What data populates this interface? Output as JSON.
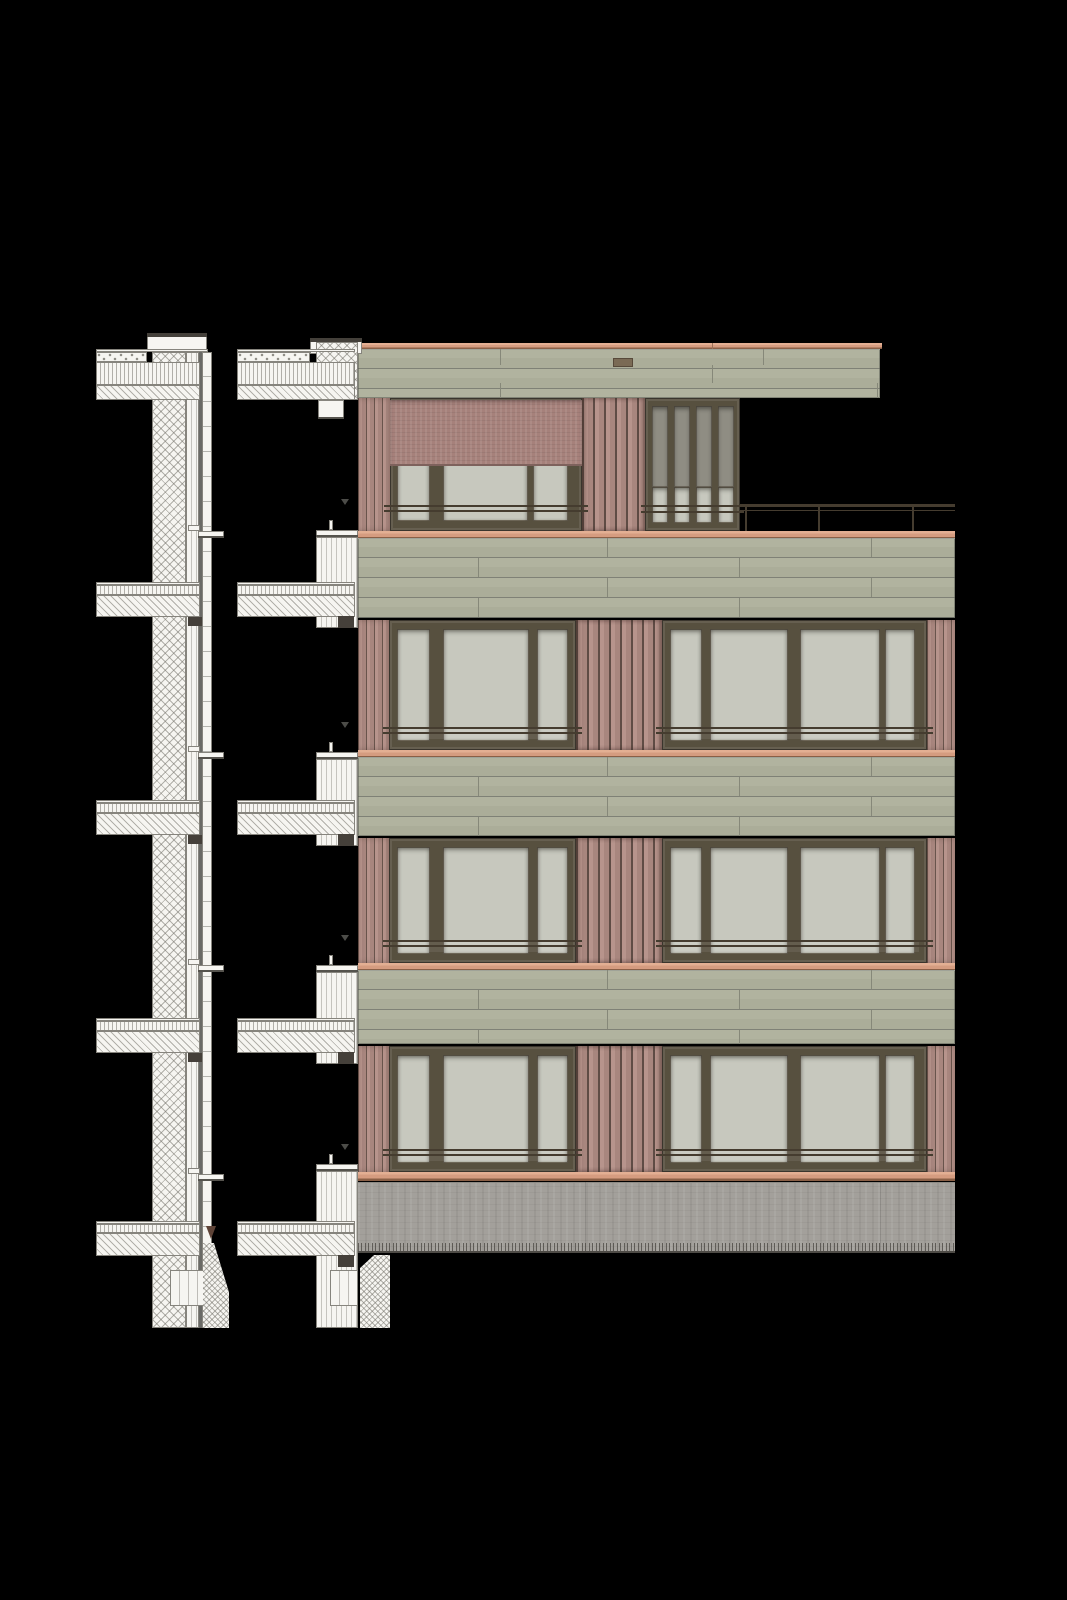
{
  "drawing": {
    "type": "architectural-facade-elevation-with-wall-sections",
    "canvas": {
      "width": 1067,
      "height": 1600
    },
    "palette": {
      "bg": "#000000",
      "paper": "#f6f5f1",
      "line": "#86847d",
      "hatch": "rgba(108,106,98,0.5)",
      "copper": "#d59c80",
      "green": "#aeb09c",
      "green_seam": "#7f8176",
      "red_board": "#ae8c84",
      "red_gap": "#5f4c45",
      "frame": "#57503f",
      "glass": "#c7c8be",
      "glass_dark": "#8f8d83",
      "railing": "#4a4034",
      "awning": "#a6817b",
      "concrete": "#a3a09b",
      "marker": "#4c4c48",
      "grade_arrow": "#5e4337",
      "vent": "#7a6a55"
    },
    "elevation": {
      "x": 358,
      "w": 597,
      "roof": {
        "coping": {
          "y": 343,
          "h": 6,
          "w": 524
        },
        "fascia": {
          "y": 349,
          "h": 49,
          "w": 522
        },
        "joint_rows": [
          {
            "y": 349,
            "h": 16,
            "xs": [
              500,
              763
            ]
          },
          {
            "y": 365,
            "h": 18,
            "xs": [
              712
            ]
          },
          {
            "y": 383,
            "h": 15,
            "xs": [
              500,
              877
            ]
          }
        ],
        "vent": {
          "x": 613,
          "y": 358,
          "w": 20,
          "h": 9
        },
        "tick_x": 712
      },
      "penthouse": {
        "y": 398,
        "h": 133,
        "piers": [
          {
            "x": 358,
            "w": 32,
            "pitch": 8
          },
          {
            "x": 582,
            "w": 63,
            "pitch": 11
          }
        ],
        "window": {
          "x": 390,
          "w": 192,
          "panes": [
            [
              397,
              33
            ],
            [
              443,
              85
            ],
            [
              533,
              35
            ]
          ],
          "pane_y": 406,
          "pane_h": 115,
          "rail_y": 505
        },
        "awning": {
          "x": 390,
          "w": 192,
          "y": 400,
          "h": 66
        },
        "door": {
          "x": 645,
          "w": 95,
          "panes": [
            [
              652,
              16
            ],
            [
              674,
              16
            ],
            [
              696,
              16
            ],
            [
              718,
              16
            ]
          ],
          "pane_y": 406,
          "pane_h": 117,
          "split_y": 487,
          "rail_y": 505
        },
        "terrace_copper": {
          "y": 531,
          "h": 8
        },
        "railing": {
          "x": 740,
          "w": 215,
          "rail_y": 504,
          "posts": [
            745,
            818,
            912
          ],
          "post_h": 27
        }
      },
      "floors": [
        {
          "band": 538,
          "bh": 80,
          "win": 620,
          "wh": 130,
          "sill": 750,
          "sh": 8
        },
        {
          "band": 757,
          "bh": 79,
          "win": 838,
          "wh": 125,
          "sill": 963,
          "sh": 8
        },
        {
          "band": 970,
          "bh": 74,
          "win": 1046,
          "wh": 126,
          "sill": 1172,
          "sh": 9
        }
      ],
      "band_joints": [
        [
          607,
          871
        ],
        [
          478,
          739
        ]
      ],
      "groups": [
        {
          "x": 389,
          "w": 187,
          "panes": [
            [
              397,
              33
            ],
            [
              443,
              86
            ],
            [
              537,
              31
            ]
          ]
        },
        {
          "x": 662,
          "w": 265,
          "panes": [
            [
              670,
              32
            ],
            [
              710,
              78
            ],
            [
              800,
              80
            ],
            [
              885,
              30
            ]
          ]
        }
      ],
      "piers": [
        {
          "x": 358,
          "w": 31,
          "pitch": 8
        },
        {
          "x": 576,
          "w": 86,
          "pitch": 11
        },
        {
          "x": 927,
          "w": 28,
          "pitch": 8
        }
      ],
      "base": {
        "y": 1182,
        "h": 71,
        "joints": [
          585,
          880
        ]
      },
      "markers": {
        "x": 341,
        "ys": [
          499,
          722,
          935,
          1144
        ]
      }
    },
    "sections": {
      "s1": {
        "wall": {
          "x": 152,
          "hatch_w": 34,
          "boards_x": 186,
          "boards_w": 13,
          "line_x": 199,
          "line_w": 3,
          "outer_x": 202,
          "outer_w": 10,
          "top": 352,
          "bottom": 1328
        },
        "parapet": {
          "x": 147,
          "w": 60,
          "y": 333,
          "h": 19
        },
        "roof": {
          "tongue_x": 96,
          "gravel_w": 51,
          "tongue_w": 104,
          "topline_y": 349,
          "gravel_y": 352,
          "vert_y": 362,
          "diag_y": 385,
          "diag_h": 15
        },
        "slabs": [
          582,
          800,
          1018
        ],
        "ground_slab": 1221,
        "sills": [
          531,
          752,
          965,
          1174
        ],
        "footing": {
          "x": 170,
          "w": 42,
          "y": 1270,
          "h": 36
        },
        "soil": {
          "x": 203,
          "y": 1243,
          "w": 26,
          "h": 85
        },
        "arrow": {
          "x": 206,
          "y": 1226
        }
      },
      "s2": {
        "tongue_x": 237,
        "tongue_w": 118,
        "col_x": 316,
        "col_w": 42,
        "roof": {
          "parapet_x": 310,
          "parapet_w": 52,
          "parapet_y": 338,
          "col_y": 342,
          "col_h": 58,
          "bracket_y": 400,
          "bracket_h": 19
        },
        "junctions": [
          {
            "sill": 530,
            "slab": 582
          },
          {
            "sill": 752,
            "slab": 800
          },
          {
            "sill": 965,
            "slab": 1018
          }
        ],
        "ground": {
          "sill": 1164,
          "slab": 1221,
          "col_bottom": 1328
        },
        "footing": {
          "x": 330,
          "w": 28,
          "y": 1270,
          "h": 36
        },
        "soil": {
          "x": 360,
          "y": 1255,
          "w": 30,
          "h": 73
        }
      }
    }
  }
}
